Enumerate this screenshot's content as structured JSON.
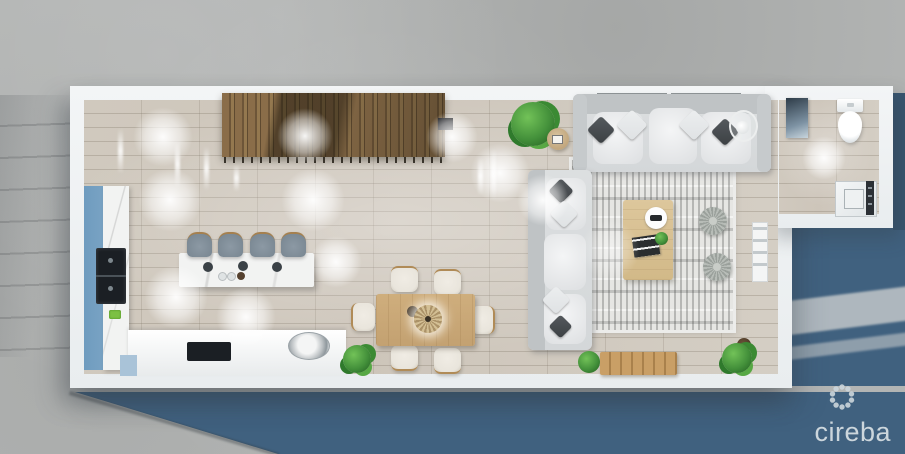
{
  "image": {
    "width": 905,
    "height": 454,
    "kind": "3d-rendered top-down floor plan of an open-plan residence"
  },
  "branding": {
    "logo_text": "cireba",
    "logo_icon": "dotted-flower-icon",
    "logo_color": "#ccd6dc"
  },
  "palette": {
    "concrete": "#b3b5b4",
    "water_blue": "#40617f",
    "wall_white": "#f3f5f6",
    "floor_wood": "#cdc5ba",
    "stair_wood": "#8a6d49",
    "cabinet_blue": "#7ea6c6",
    "appliance_black": "#1b1f24",
    "island_marble": "#f2f3f2",
    "stool_gray": "#8c99a4",
    "table_wood": "#c3a171",
    "chair_cream": "#e9e5dc",
    "sofa_gray": "#d4d7d9",
    "pillow_dark": "#3c4043",
    "pillow_light": "#dfe2e4",
    "rug_base": "#e6e6e3",
    "plant_green": "#44913b",
    "pouf_gray": "#b7bcb7",
    "logo_color": "#ccd6dc"
  },
  "scene": {
    "rooms": [
      "kitchen",
      "dining-area",
      "living-room",
      "bathroom",
      "staircase",
      "rear-terrace"
    ],
    "counts": {
      "bar_stools": 4,
      "dining_chairs": 6,
      "sofas": 2,
      "poufs": 2,
      "potted_plants": 5,
      "ceiling_light_glows": 12
    },
    "furniture": [
      "kitchen-island",
      "bar-stools",
      "wall-oven-stack",
      "cooktop",
      "round-sink",
      "blue-cabinet-run",
      "dining-table",
      "rattan-centerpiece",
      "dining-chairs",
      "wooden-staircase",
      "sofa",
      "chaise-sofa",
      "area-rug",
      "coffee-table",
      "tray",
      "books",
      "floor-poufs",
      "floor-lamp",
      "side-table",
      "blanket-ladder",
      "outdoor-bench",
      "toilet",
      "bathroom-vanity",
      "shower-panel",
      "plants"
    ]
  }
}
